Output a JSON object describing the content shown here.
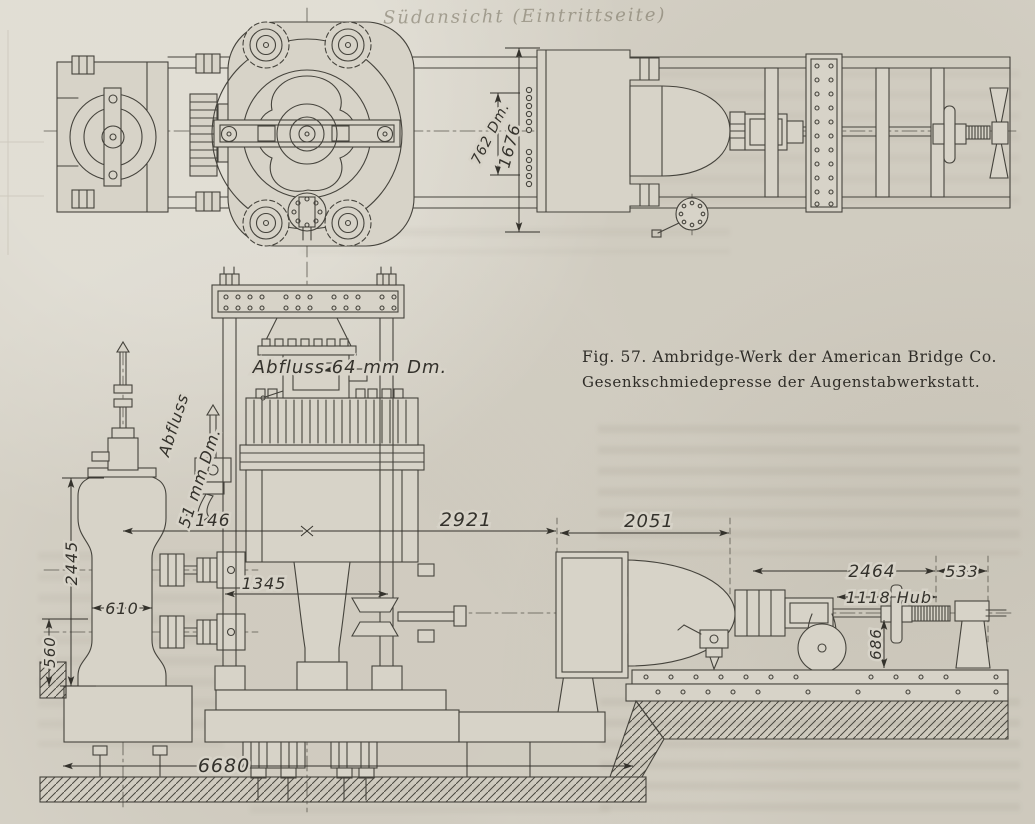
{
  "figure": {
    "caption_line1": "Fig. 57.  Ambridge-Werk der American Bridge Co.",
    "caption_line2": "Gesenkschmiedepresse der Augenstabwerkstatt."
  },
  "ghost_text": "Südansicht (Eintrittseite)",
  "plan_view": {
    "dims": {
      "d762": "762 Dm.",
      "d1676": "1676"
    }
  },
  "elevation_view": {
    "labels": {
      "abfluss_64": "Abfluss 64 mm Dm.",
      "abfluss": "Abfluss",
      "abfluss_51": "51 mm Dm."
    },
    "dims": {
      "d2146": "2146",
      "d2921": "2921",
      "d2051": "2051",
      "d1345": "1345",
      "d2445": "2445",
      "d610": "610",
      "d560": "560",
      "d6680": "6680",
      "d2464": "2464",
      "d533": "533",
      "d1118": "1118 Hub",
      "d686": "686"
    }
  },
  "colors": {
    "paper": "#d7d3c8",
    "ink": "#45433c",
    "dim_ink": "#34322c"
  }
}
